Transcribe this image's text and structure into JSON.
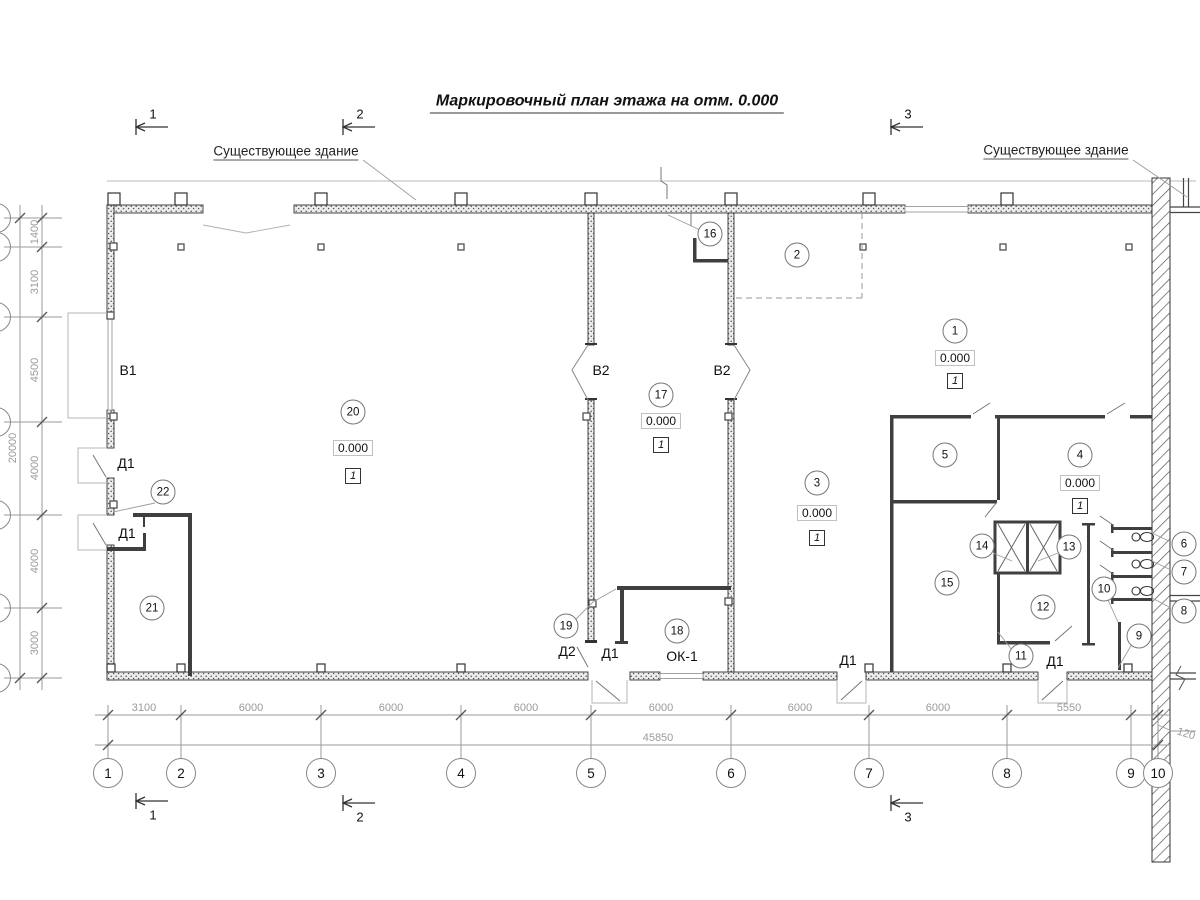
{
  "title": {
    "text": "Маркировочный план этажа на отм. 0.000",
    "x": 607,
    "y": 103
  },
  "elevation_value": "0.000",
  "category_value": "1",
  "annotations": [
    {
      "text": "Существующее здание",
      "x": 286,
      "y": 152
    },
    {
      "text": "Существующее здание",
      "x": 1056,
      "y": 151
    }
  ],
  "labels": [
    {
      "text": "В1",
      "x": 128,
      "y": 370
    },
    {
      "text": "В2",
      "x": 601,
      "y": 370
    },
    {
      "text": "В2",
      "x": 722,
      "y": 370
    },
    {
      "text": "Д1",
      "x": 126,
      "y": 463
    },
    {
      "text": "Д1",
      "x": 127,
      "y": 533
    },
    {
      "text": "Д2",
      "x": 567,
      "y": 651
    },
    {
      "text": "Д1",
      "x": 610,
      "y": 653
    },
    {
      "text": "ОК-1",
      "x": 682,
      "y": 656
    },
    {
      "text": "Д1",
      "x": 848,
      "y": 660
    },
    {
      "text": "Д1",
      "x": 1055,
      "y": 661
    }
  ],
  "rooms": [
    {
      "n": "1",
      "x": 955,
      "y": 331,
      "elev_y": 358,
      "cat_y": 381
    },
    {
      "n": "2",
      "x": 797,
      "y": 255
    },
    {
      "n": "3",
      "x": 817,
      "y": 483,
      "elev_y": 513,
      "cat_y": 538
    },
    {
      "n": "4",
      "x": 1080,
      "y": 455,
      "elev_y": 483,
      "cat_y": 506
    },
    {
      "n": "5",
      "x": 945,
      "y": 455
    },
    {
      "n": "6",
      "x": 1184,
      "y": 544
    },
    {
      "n": "7",
      "x": 1184,
      "y": 572
    },
    {
      "n": "8",
      "x": 1184,
      "y": 611
    },
    {
      "n": "9",
      "x": 1139,
      "y": 636
    },
    {
      "n": "10",
      "x": 1104,
      "y": 589
    },
    {
      "n": "11",
      "x": 1021,
      "y": 656
    },
    {
      "n": "12",
      "x": 1043,
      "y": 607
    },
    {
      "n": "13",
      "x": 1069,
      "y": 547
    },
    {
      "n": "14",
      "x": 982,
      "y": 546
    },
    {
      "n": "15",
      "x": 947,
      "y": 583
    },
    {
      "n": "16",
      "x": 710,
      "y": 234
    },
    {
      "n": "17",
      "x": 661,
      "y": 395,
      "elev_y": 421,
      "cat_y": 445
    },
    {
      "n": "18",
      "x": 677,
      "y": 631
    },
    {
      "n": "19",
      "x": 566,
      "y": 626
    },
    {
      "n": "20",
      "x": 353,
      "y": 412,
      "elev_y": 448,
      "cat_y": 476
    },
    {
      "n": "21",
      "x": 152,
      "y": 608
    },
    {
      "n": "22",
      "x": 163,
      "y": 492
    }
  ],
  "section_markers": [
    {
      "n": "1",
      "x": 135,
      "y": 127,
      "pos": "top"
    },
    {
      "n": "2",
      "x": 342,
      "y": 127,
      "pos": "top"
    },
    {
      "n": "3",
      "x": 890,
      "y": 127,
      "pos": "top"
    },
    {
      "n": "1",
      "x": 135,
      "y": 801,
      "pos": "bottom"
    },
    {
      "n": "2",
      "x": 342,
      "y": 803,
      "pos": "bottom"
    },
    {
      "n": "3",
      "x": 890,
      "y": 803,
      "pos": "bottom"
    }
  ],
  "axes_bottom_y": 773,
  "axes_bottom": [
    {
      "n": "1",
      "x": 108
    },
    {
      "n": "2",
      "x": 181
    },
    {
      "n": "3",
      "x": 321
    },
    {
      "n": "4",
      "x": 461
    },
    {
      "n": "5",
      "x": 591
    },
    {
      "n": "6",
      "x": 731
    },
    {
      "n": "7",
      "x": 869
    },
    {
      "n": "8",
      "x": 1007
    },
    {
      "n": "9",
      "x": 1131
    },
    {
      "n": "10",
      "x": 1158
    }
  ],
  "axes_left_rows": [
    218,
    247,
    317,
    422,
    515,
    608,
    678
  ],
  "dims_bottom_y": 708,
  "dims_bottom": [
    {
      "v": "3100",
      "x": 144
    },
    {
      "v": "6000",
      "x": 251
    },
    {
      "v": "6000",
      "x": 391
    },
    {
      "v": "6000",
      "x": 526
    },
    {
      "v": "6000",
      "x": 661
    },
    {
      "v": "6000",
      "x": 800
    },
    {
      "v": "6000",
      "x": 938
    },
    {
      "v": "5550",
      "x": 1069
    }
  ],
  "overall_bottom": {
    "v": "45850",
    "x": 658,
    "y": 738
  },
  "dim_120": {
    "v": "120",
    "x": 1186,
    "y": 734,
    "rot": 17
  },
  "dims_left_x": 35,
  "dims_left": [
    {
      "v": "1400",
      "y": 232
    },
    {
      "v": "3100",
      "y": 282
    },
    {
      "v": "4500",
      "y": 370
    },
    {
      "v": "4000",
      "y": 468
    },
    {
      "v": "4000",
      "y": 561
    },
    {
      "v": "3000",
      "y": 643
    }
  ],
  "overall_left": {
    "v": "20000",
    "x": 13,
    "y": 448
  }
}
